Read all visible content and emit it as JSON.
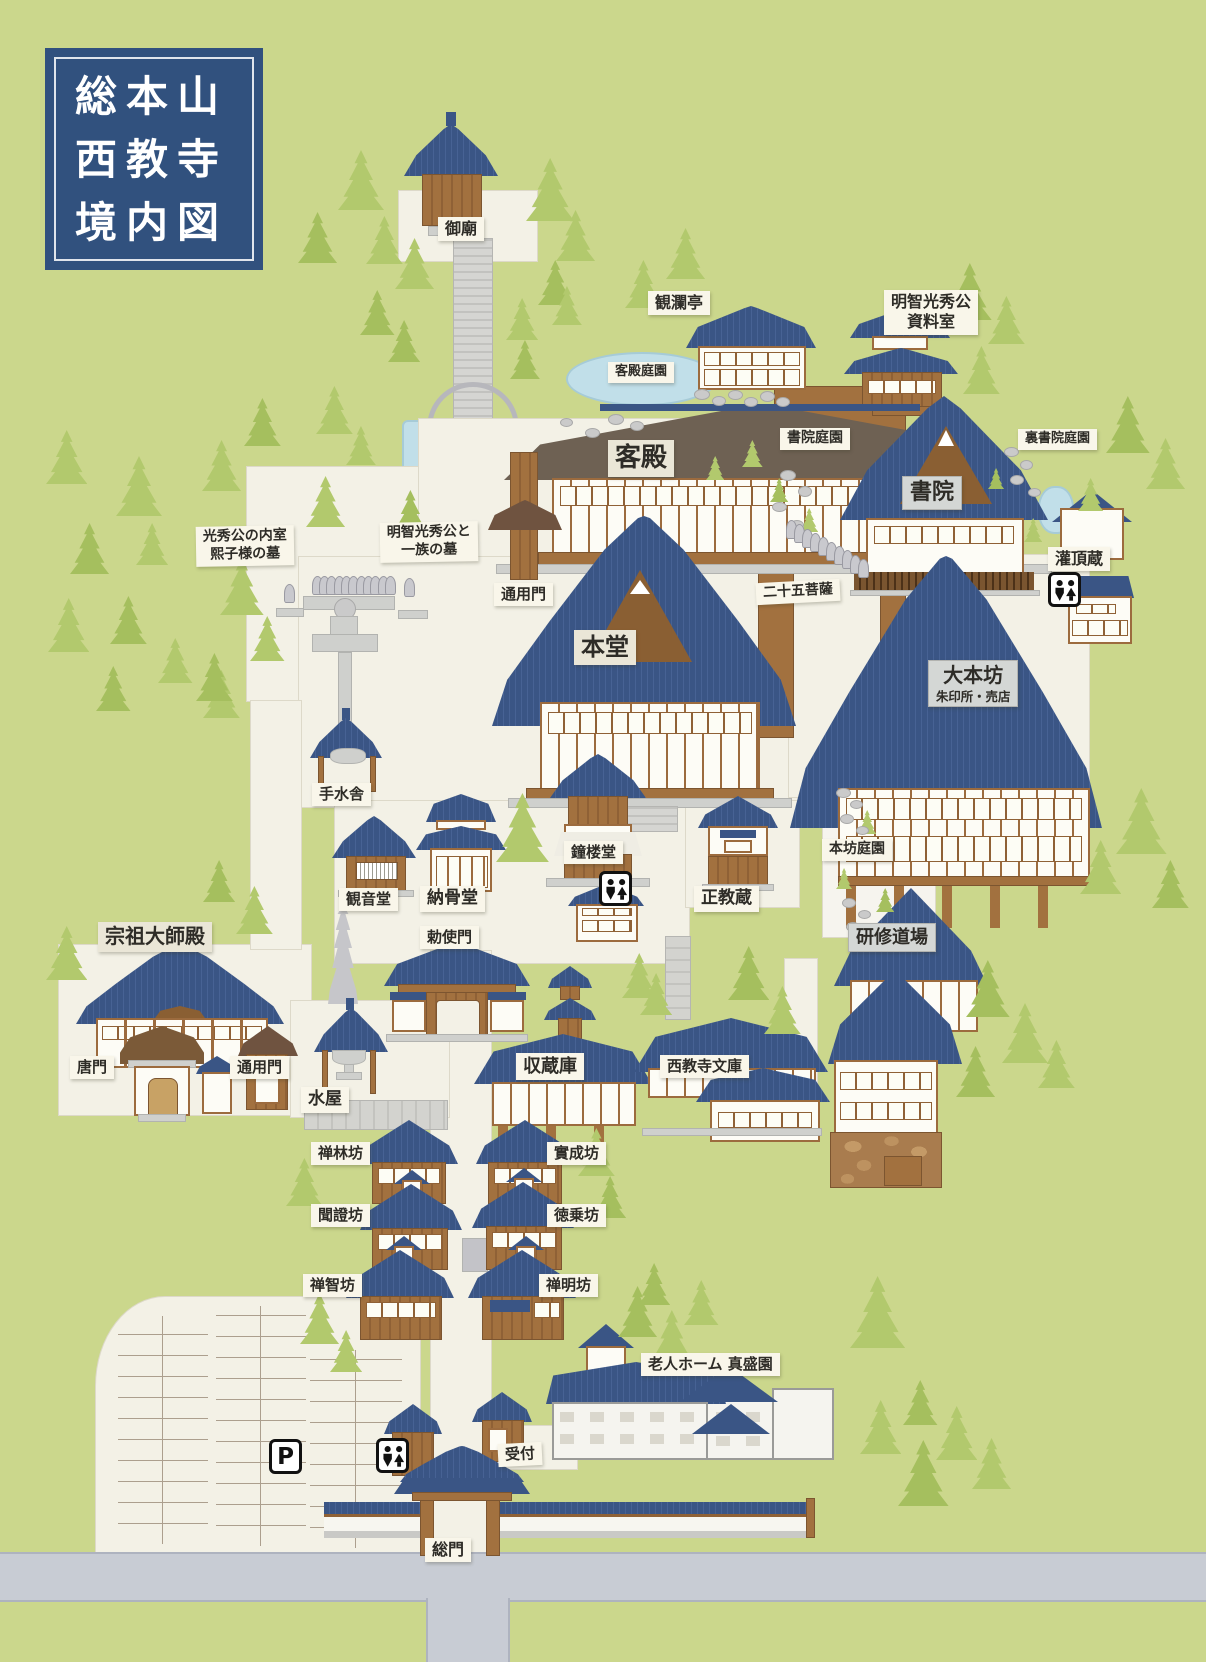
{
  "title": {
    "line1": "総本山",
    "line2": "西教寺",
    "line3": "境内図"
  },
  "colors": {
    "grass": "#cbd78c",
    "path": "#f3f1e6",
    "roof_blue": "#3a5585",
    "roof_brown": "#6e6153",
    "wood": "#a2713f",
    "road": "#c8ccd4",
    "water": "#c1dfe9",
    "sign_bg": "#f9f6ea",
    "sign_major_bg": "#d4d7d5",
    "title_bg": "#31517e",
    "tree": "#b2c96d",
    "stone": "#cacaca"
  },
  "labels": [
    {
      "id": "gobyo",
      "text": "御廟",
      "x": 438,
      "y": 217,
      "fs": 16
    },
    {
      "id": "kanrantei",
      "text": "観瀾亭",
      "x": 648,
      "y": 291,
      "fs": 16
    },
    {
      "id": "shiryoshitsu",
      "text": "明智光秀公\n資料室",
      "x": 884,
      "y": 290,
      "fs": 16
    },
    {
      "id": "kyakuden-teien",
      "text": "客殿庭園",
      "x": 608,
      "y": 362,
      "fs": 13
    },
    {
      "id": "shoin-teien",
      "text": "書院庭園",
      "x": 780,
      "y": 428,
      "fs": 14
    },
    {
      "id": "ura-shoin-teien",
      "text": "裏書院庭園",
      "x": 1018,
      "y": 429,
      "fs": 13
    },
    {
      "id": "kyakuden",
      "text": "客殿",
      "x": 608,
      "y": 440,
      "fs": 26,
      "style": "beige"
    },
    {
      "id": "shoin",
      "text": "書院",
      "x": 902,
      "y": 476,
      "fs": 22,
      "style": "gray"
    },
    {
      "id": "kanjozo",
      "text": "灌頂蔵",
      "x": 1048,
      "y": 547,
      "fs": 16
    },
    {
      "id": "hiroko-haka",
      "text": "光秀公の内室\n熙子様の墓",
      "x": 196,
      "y": 526,
      "fs": 14,
      "rot": -1
    },
    {
      "id": "mitsuhide-haka",
      "text": "明智光秀公と\n一族の墓",
      "x": 380,
      "y": 522,
      "fs": 14,
      "rot": -1
    },
    {
      "id": "tsuyomon-upper",
      "text": "通用門",
      "x": 494,
      "y": 583,
      "fs": 15
    },
    {
      "id": "nijugo-bosatsu",
      "text": "二十五菩薩",
      "x": 756,
      "y": 581,
      "fs": 14,
      "rot": -3
    },
    {
      "id": "hondo",
      "text": "本堂",
      "x": 574,
      "y": 630,
      "fs": 24,
      "style": "beige"
    },
    {
      "id": "daihonbo",
      "text": "大本坊",
      "sub": "朱印所・売店",
      "x": 928,
      "y": 660,
      "fs": 20,
      "style": "gray"
    },
    {
      "id": "chozuya",
      "text": "手水舎",
      "x": 312,
      "y": 783,
      "fs": 15
    },
    {
      "id": "honbo-teien",
      "text": "本坊庭園",
      "x": 822,
      "y": 839,
      "fs": 14
    },
    {
      "id": "shoro-do",
      "text": "鐘楼堂",
      "x": 564,
      "y": 841,
      "fs": 15
    },
    {
      "id": "kannon-do",
      "text": "観音堂",
      "x": 339,
      "y": 888,
      "fs": 15
    },
    {
      "id": "nokotsu-do",
      "text": "納骨堂",
      "x": 420,
      "y": 886,
      "fs": 17
    },
    {
      "id": "seikyozo",
      "text": "正教蔵",
      "x": 694,
      "y": 886,
      "fs": 17
    },
    {
      "id": "kenshu-dojo",
      "text": "研修道場",
      "x": 848,
      "y": 923,
      "fs": 18,
      "style": "gray"
    },
    {
      "id": "chokushimon",
      "text": "勅使門",
      "x": 420,
      "y": 926,
      "fs": 15
    },
    {
      "id": "soso-daishiden",
      "text": "宗祖大師殿",
      "x": 98,
      "y": 922,
      "fs": 20,
      "style": "beige"
    },
    {
      "id": "karamon",
      "text": "唐門",
      "x": 70,
      "y": 1056,
      "fs": 15
    },
    {
      "id": "tsuyomon-lower",
      "text": "通用門",
      "x": 230,
      "y": 1056,
      "fs": 15
    },
    {
      "id": "mizuya",
      "text": "水屋",
      "x": 301,
      "y": 1087,
      "fs": 17
    },
    {
      "id": "shuzoko",
      "text": "収蔵庫",
      "x": 516,
      "y": 1053,
      "fs": 18
    },
    {
      "id": "bunko",
      "text": "西教寺文庫",
      "x": 660,
      "y": 1055,
      "fs": 15
    },
    {
      "id": "zenrinbo",
      "text": "禅林坊",
      "x": 311,
      "y": 1142,
      "fs": 15
    },
    {
      "id": "jitsujobo",
      "text": "實成坊",
      "x": 547,
      "y": 1142,
      "fs": 15
    },
    {
      "id": "monshobo",
      "text": "聞證坊",
      "x": 311,
      "y": 1204,
      "fs": 15
    },
    {
      "id": "tokujobo",
      "text": "徳乗坊",
      "x": 547,
      "y": 1204,
      "fs": 15
    },
    {
      "id": "zenchibo",
      "text": "禅智坊",
      "x": 303,
      "y": 1274,
      "fs": 15
    },
    {
      "id": "zenmyobo",
      "text": "禅明坊",
      "x": 539,
      "y": 1274,
      "fs": 15
    },
    {
      "id": "shinseien",
      "text": "老人ホーム 真盛園",
      "x": 641,
      "y": 1353,
      "fs": 15
    },
    {
      "id": "uketsuke",
      "text": "受付",
      "x": 498,
      "y": 1443,
      "fs": 15,
      "rot": -3
    },
    {
      "id": "somon",
      "text": "総門",
      "x": 425,
      "y": 1538,
      "fs": 16
    }
  ],
  "icons": [
    {
      "type": "toilet",
      "x": 1048,
      "y": 572
    },
    {
      "type": "toilet",
      "x": 599,
      "y": 871
    },
    {
      "type": "toilet",
      "x": 376,
      "y": 1438
    },
    {
      "type": "parking",
      "glyph": "P",
      "x": 269,
      "y": 1439
    }
  ],
  "decor": {
    "trees": [
      [
        338,
        150,
        1.0
      ],
      [
        298,
        212,
        0.85
      ],
      [
        366,
        216,
        0.8
      ],
      [
        395,
        238,
        0.85
      ],
      [
        360,
        290,
        0.75
      ],
      [
        316,
        386,
        0.8
      ],
      [
        346,
        426,
        0.65
      ],
      [
        388,
        320,
        0.7
      ],
      [
        526,
        158,
        1.05
      ],
      [
        556,
        210,
        0.85
      ],
      [
        538,
        260,
        0.75
      ],
      [
        506,
        298,
        0.7
      ],
      [
        552,
        286,
        0.65
      ],
      [
        510,
        340,
        0.65
      ],
      [
        625,
        260,
        0.8
      ],
      [
        666,
        228,
        0.85
      ],
      [
        948,
        263,
        0.95
      ],
      [
        988,
        296,
        0.8
      ],
      [
        963,
        346,
        0.8
      ],
      [
        1106,
        396,
        0.95
      ],
      [
        1146,
        438,
        0.85
      ],
      [
        1078,
        478,
        0.55
      ],
      [
        244,
        398,
        0.8
      ],
      [
        202,
        440,
        0.85
      ],
      [
        306,
        476,
        0.85
      ],
      [
        392,
        490,
        0.8
      ],
      [
        46,
        430,
        0.9
      ],
      [
        116,
        456,
        1.0
      ],
      [
        70,
        523,
        0.85
      ],
      [
        136,
        523,
        0.7
      ],
      [
        48,
        598,
        0.9
      ],
      [
        110,
        596,
        0.8
      ],
      [
        158,
        638,
        0.75
      ],
      [
        203,
        670,
        0.8
      ],
      [
        96,
        666,
        0.75
      ],
      [
        220,
        558,
        0.95
      ],
      [
        250,
        616,
        0.75
      ],
      [
        196,
        653,
        0.8
      ],
      [
        742,
        440,
        0.45
      ],
      [
        706,
        456,
        0.4
      ],
      [
        770,
        478,
        0.4
      ],
      [
        800,
        508,
        0.4
      ],
      [
        1024,
        518,
        0.4
      ],
      [
        988,
        468,
        0.35
      ],
      [
        1116,
        788,
        1.1
      ],
      [
        1080,
        840,
        0.9
      ],
      [
        1152,
        860,
        0.8
      ],
      [
        496,
        793,
        1.15
      ],
      [
        622,
        953,
        0.75
      ],
      [
        728,
        946,
        0.9
      ],
      [
        764,
        986,
        0.8
      ],
      [
        640,
        973,
        0.7
      ],
      [
        966,
        960,
        0.95
      ],
      [
        1002,
        1003,
        1.0
      ],
      [
        1038,
        1040,
        0.8
      ],
      [
        956,
        1046,
        0.85
      ],
      [
        46,
        926,
        0.9
      ],
      [
        236,
        886,
        0.8
      ],
      [
        203,
        860,
        0.7
      ],
      [
        286,
        1158,
        0.8
      ],
      [
        578,
        1128,
        0.8
      ],
      [
        594,
        1176,
        0.7
      ],
      [
        300,
        1293,
        0.85
      ],
      [
        330,
        1330,
        0.7
      ],
      [
        618,
        1286,
        0.85
      ],
      [
        650,
        1310,
        0.95
      ],
      [
        684,
        1280,
        0.75
      ],
      [
        638,
        1263,
        0.7
      ],
      [
        850,
        1276,
        1.2
      ],
      [
        860,
        1400,
        0.9
      ],
      [
        898,
        1440,
        1.1
      ],
      [
        936,
        1406,
        0.9
      ],
      [
        972,
        1438,
        0.85
      ],
      [
        903,
        1380,
        0.75
      ],
      [
        858,
        810,
        0.4
      ],
      [
        836,
        868,
        0.35
      ],
      [
        876,
        888,
        0.4
      ]
    ],
    "stones": [
      [
        694,
        389,
        14,
        9
      ],
      [
        712,
        396,
        12,
        8
      ],
      [
        728,
        390,
        13,
        8
      ],
      [
        744,
        397,
        12,
        8
      ],
      [
        760,
        391,
        13,
        9
      ],
      [
        776,
        397,
        12,
        8
      ],
      [
        608,
        414,
        14,
        9
      ],
      [
        630,
        421,
        12,
        8
      ],
      [
        585,
        428,
        13,
        8
      ],
      [
        560,
        418,
        11,
        7
      ],
      [
        780,
        470,
        14,
        9
      ],
      [
        798,
        486,
        12,
        9
      ],
      [
        772,
        502,
        13,
        8
      ],
      [
        790,
        520,
        12,
        8
      ],
      [
        808,
        538,
        13,
        9
      ],
      [
        1004,
        447,
        13,
        8
      ],
      [
        1020,
        460,
        11,
        8
      ],
      [
        1010,
        475,
        12,
        8
      ],
      [
        1028,
        488,
        11,
        7
      ],
      [
        836,
        788,
        13,
        8
      ],
      [
        850,
        800,
        11,
        7
      ],
      [
        840,
        814,
        12,
        8
      ],
      [
        856,
        826,
        11,
        7
      ],
      [
        868,
        840,
        12,
        8
      ],
      [
        842,
        898,
        12,
        8
      ],
      [
        858,
        910,
        11,
        7
      ],
      [
        846,
        922,
        12,
        8
      ]
    ],
    "bosatsu_statues": [
      [
        786,
        520
      ],
      [
        794,
        524
      ],
      [
        802,
        529
      ],
      [
        810,
        533
      ],
      [
        818,
        537
      ],
      [
        826,
        542
      ],
      [
        834,
        546
      ],
      [
        842,
        550
      ],
      [
        850,
        555
      ],
      [
        858,
        559
      ]
    ],
    "grave_statues": [
      [
        312,
        576
      ],
      [
        319,
        576
      ],
      [
        326,
        576
      ],
      [
        334,
        576
      ],
      [
        341,
        576
      ],
      [
        348,
        576
      ],
      [
        356,
        576
      ],
      [
        363,
        576
      ],
      [
        370,
        576
      ],
      [
        378,
        576
      ],
      [
        385,
        576
      ],
      [
        284,
        584
      ],
      [
        404,
        578
      ]
    ]
  }
}
